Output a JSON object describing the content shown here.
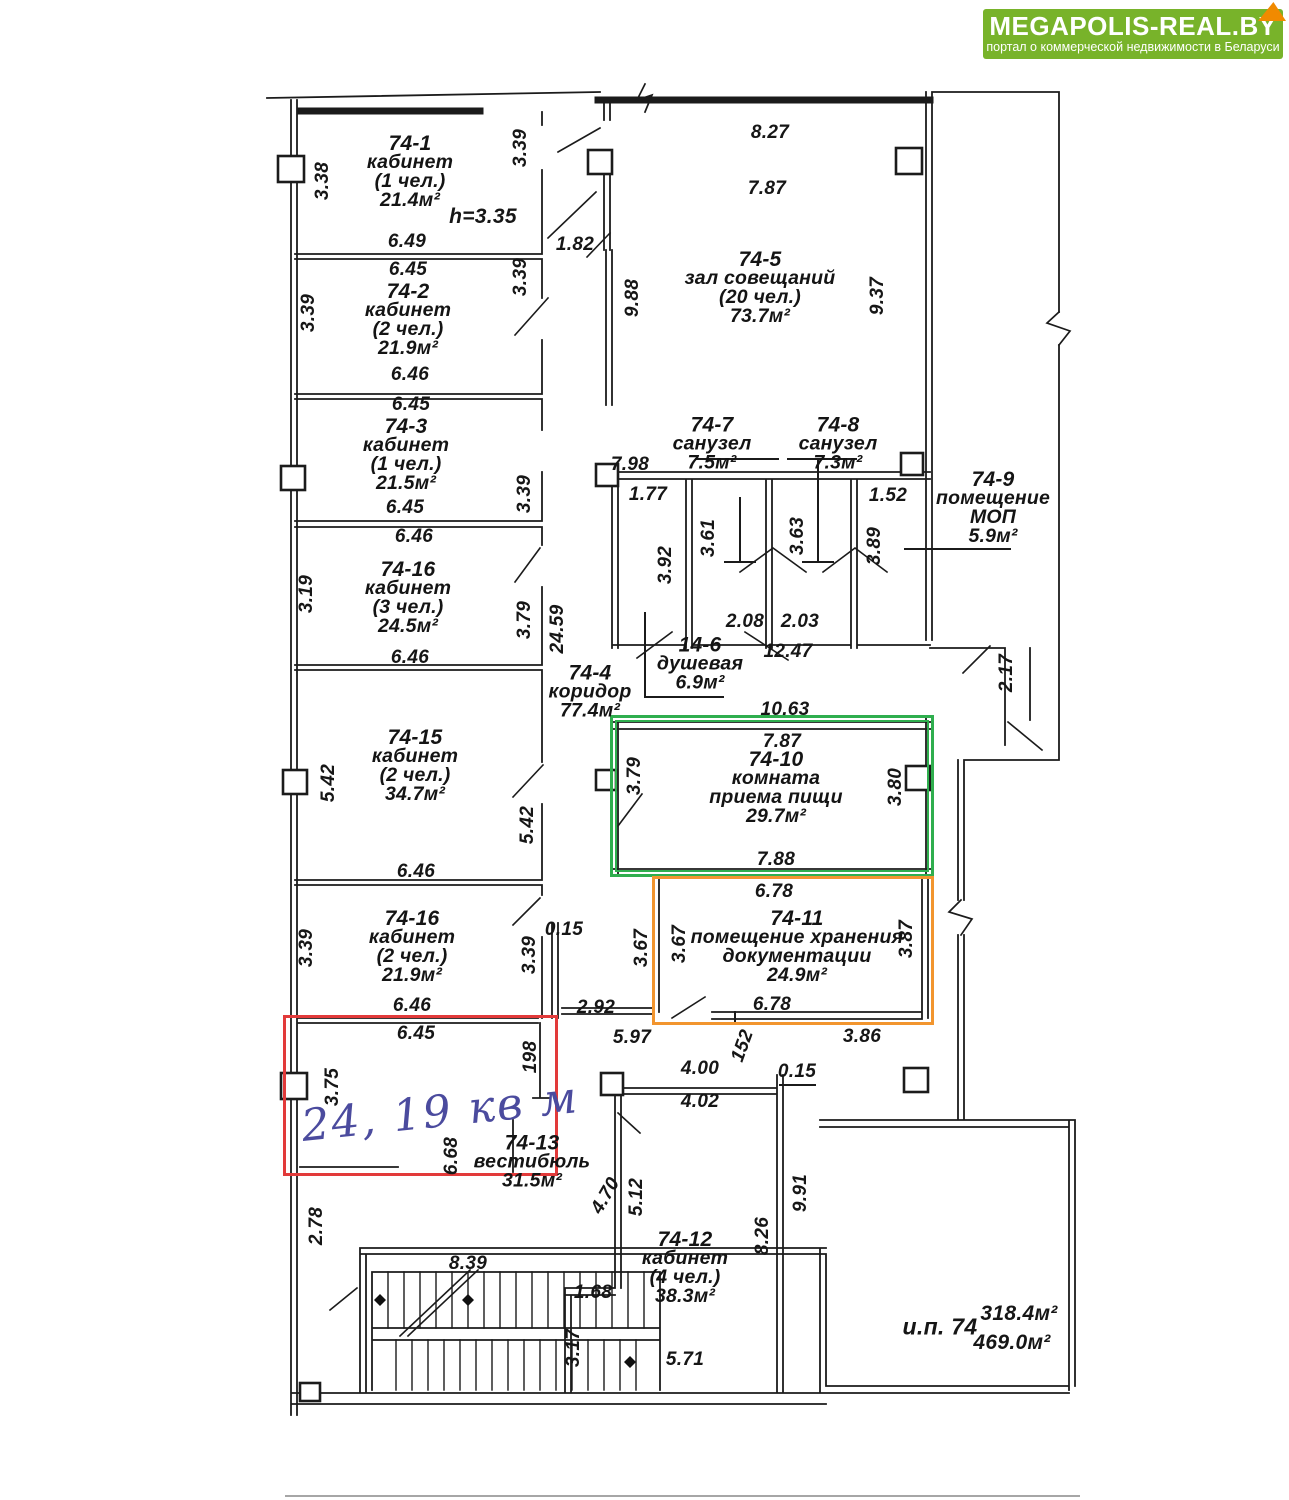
{
  "logo": {
    "title": "MEGAPOLIS-REAL.BY",
    "subtitle": "портал о коммерческой недвижимости в Беларуси"
  },
  "colors": {
    "logo_green": "#78b32a",
    "logo_fold": "#f18a00",
    "highlight_red": "#e23a3a",
    "highlight_green": "#2fae4e",
    "highlight_orange": "#f2952e",
    "ink_blue": "#4b4b9e"
  },
  "handwriting": "24, 19 кв м",
  "annotations": {
    "height_note": "h=3.35"
  },
  "totals": {
    "label": "и.п. 74",
    "area_top": "318.4м²",
    "area_bottom": "469.0м²"
  },
  "rooms": [
    {
      "num": "74-1",
      "l1": "кабинет",
      "l2": "(1 чел.)",
      "area": "21.4м²"
    },
    {
      "num": "74-2",
      "l1": "кабинет",
      "l2": "(2 чел.)",
      "area": "21.9м²"
    },
    {
      "num": "74-3",
      "l1": "кабинет",
      "l2": "(1 чел.)",
      "area": "21.5м²"
    },
    {
      "num": "74-16",
      "l1": "кабинет",
      "l2": "(3 чел.)",
      "area": "24.5м²"
    },
    {
      "num": "74-15",
      "l1": "кабинет",
      "l2": "(2 чел.)",
      "area": "34.7м²"
    },
    {
      "num": "74-16",
      "l1": "кабинет",
      "l2": "(2 чел.)",
      "area": "21.9м²"
    },
    {
      "num": "74-4",
      "l1": "коридор",
      "area": "77.4м²"
    },
    {
      "num": "74-5",
      "l1": "зал совещаний",
      "l2": "(20 чел.)",
      "area": "73.7м²"
    },
    {
      "num": "74-7",
      "l1": "санузел",
      "area": "7.5м²"
    },
    {
      "num": "74-8",
      "l1": "санузел",
      "area": "7.3м²"
    },
    {
      "num": "14-6",
      "l1": "душевая",
      "area": "6.9м²"
    },
    {
      "num": "74-9",
      "l1": "помещение",
      "l2": "МОП",
      "area": "5.9м²"
    },
    {
      "num": "74-10",
      "l1": "комната",
      "l2": "приема пищи",
      "area": "29.7м²"
    },
    {
      "num": "74-11",
      "l1": "помещение хранения",
      "l2": "документации",
      "area": "24.9м²"
    },
    {
      "num": "74-13",
      "l1": "вестибюль",
      "area": "31.5м²"
    },
    {
      "num": "74-12",
      "l1": "кабинет",
      "l2": "(4 чел.)",
      "area": "38.3м²"
    }
  ],
  "dims": {
    "h": [
      "6.49",
      "6.45",
      "6.46",
      "6.45",
      "6.45",
      "6.46",
      "6.46",
      "6.46",
      "6.46",
      "6.45",
      "1.82",
      "8.27",
      "7.87",
      "7.98",
      "1.77",
      "2.08",
      "2.03",
      "12.47",
      "1.52",
      "10.63",
      "7.87",
      "7.88",
      "6.78",
      "6.78",
      "2.92",
      "5.97",
      "3.86",
      "0.15",
      "0.15",
      "4.00",
      "4.02",
      "1.68",
      "5.71",
      "8.39"
    ],
    "v": [
      "3.38",
      "3.39",
      "3.39",
      "3.39",
      "3.39",
      "3.19",
      "3.79",
      "24.59",
      "9.88",
      "9.37",
      "5.42",
      "5.42",
      "3.39",
      "3.39",
      "3.75",
      "198",
      "3.92",
      "3.61",
      "3.63",
      "3.89",
      "2.17",
      "3.79",
      "3.80",
      "3.67",
      "3.67",
      "3.87",
      "152",
      "5.12",
      "4.70",
      "8.26",
      "9.91",
      "3.17",
      "2.78",
      "6.68"
    ]
  }
}
